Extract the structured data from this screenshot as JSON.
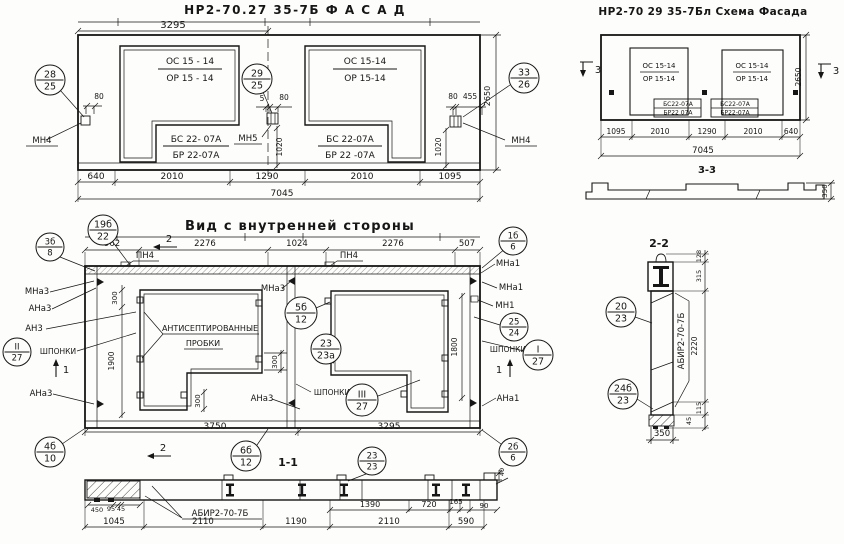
{
  "colors": {
    "ink": "#161616",
    "paper": "#fdfdfb"
  },
  "views": {
    "facade": {
      "title": "НР2-70.27 35-7Б    Ф А С А Д"
    },
    "scheme": {
      "title": "НР2-70 29 35-7Бл  Схема Фасада"
    },
    "inner": {
      "title": "Вид с внутренней стороны"
    },
    "section11": {
      "title": "1-1"
    },
    "section22": {
      "title": "2-2"
    },
    "section33": {
      "title": "3-3"
    }
  },
  "annotations": {
    "facade": [
      {
        "n": "dim-3295",
        "t": "3295",
        "x": 173,
        "y": 28,
        "s": 10
      },
      {
        "n": "window-mark-os",
        "t": "ОС 15 - 14",
        "x": 190,
        "y": 64,
        "s": 9
      },
      {
        "n": "window-mark-or",
        "t": "ОР 15 - 14",
        "x": 190,
        "y": 81,
        "s": 9
      },
      {
        "n": "window-mark-os",
        "t": "ОС 15-14",
        "x": 365,
        "y": 64,
        "s": 9
      },
      {
        "n": "window-mark-or",
        "t": "ОР 15-14",
        "x": 365,
        "y": 81,
        "s": 9
      },
      {
        "n": "sill-mark-bs",
        "t": "БС 22- 07А",
        "x": 196,
        "y": 142,
        "s": 9
      },
      {
        "n": "sill-mark-br",
        "t": "БР 22-07А",
        "x": 196,
        "y": 158,
        "s": 9
      },
      {
        "n": "sill-mark-bs",
        "t": "БС 22-07А",
        "x": 350,
        "y": 142,
        "s": 9
      },
      {
        "n": "sill-mark-br",
        "t": "БР 22 -07А",
        "x": 350,
        "y": 158,
        "s": 9
      },
      {
        "n": "dim-80",
        "t": "80",
        "x": 99,
        "y": 99,
        "s": 7.5
      },
      {
        "n": "anchor-label-mn4",
        "t": "МН4",
        "x": 42,
        "y": 143,
        "s": 8.5
      },
      {
        "n": "dim-5",
        "t": "5",
        "x": 262,
        "y": 101,
        "s": 7.5
      },
      {
        "n": "dim-80",
        "t": "80",
        "x": 284,
        "y": 100,
        "s": 7.5
      },
      {
        "n": "anchor-label-mn5",
        "t": "МН5",
        "x": 248,
        "y": 141,
        "s": 8.5
      },
      {
        "n": "dim-1020",
        "t": "1020",
        "x": 282,
        "y": 147,
        "s": 7.5,
        "r": -90
      },
      {
        "n": "dim-80",
        "t": "80",
        "x": 453,
        "y": 99,
        "s": 7.5
      },
      {
        "n": "dim-455",
        "t": "455",
        "x": 470,
        "y": 99,
        "s": 7.5
      },
      {
        "n": "dim-1020",
        "t": "1020",
        "x": 441,
        "y": 147,
        "s": 7.5,
        "r": -90
      },
      {
        "n": "anchor-label-mn4",
        "t": "МН4",
        "x": 521,
        "y": 143,
        "s": 8.5
      },
      {
        "n": "dim-2650",
        "t": "2650",
        "x": 490,
        "y": 96,
        "s": 8,
        "r": -90
      },
      {
        "n": "dim-640",
        "t": "640",
        "x": 96,
        "y": 179,
        "s": 9
      },
      {
        "n": "dim-2010",
        "t": "2010",
        "x": 172,
        "y": 179,
        "s": 9
      },
      {
        "n": "dim-1290",
        "t": "1290",
        "x": 267,
        "y": 179,
        "s": 9
      },
      {
        "n": "dim-2010",
        "t": "2010",
        "x": 362,
        "y": 179,
        "s": 9
      },
      {
        "n": "dim-1095",
        "t": "1095",
        "x": 450,
        "y": 179,
        "s": 9
      },
      {
        "n": "dim-7045",
        "t": "7045",
        "x": 282,
        "y": 196,
        "s": 9
      }
    ],
    "scheme": [
      {
        "n": "window-mark-os",
        "t": "ОС 15-14",
        "x": 659,
        "y": 68,
        "s": 7
      },
      {
        "n": "window-mark-or",
        "t": "ОР 15-14",
        "x": 659,
        "y": 81,
        "s": 7
      },
      {
        "n": "window-mark-os",
        "t": "ОС 15-14",
        "x": 752,
        "y": 68,
        "s": 7
      },
      {
        "n": "window-mark-or",
        "t": "ОР 15-14",
        "x": 752,
        "y": 81,
        "s": 7
      },
      {
        "n": "sill-mark-bs",
        "t": "БС22-07А",
        "x": 678,
        "y": 106,
        "s": 6
      },
      {
        "n": "sill-mark-br",
        "t": "БР22 07А",
        "x": 678,
        "y": 114.5,
        "s": 6
      },
      {
        "n": "sill-mark-bs",
        "t": "БС22-07А",
        "x": 735,
        "y": 106,
        "s": 6
      },
      {
        "n": "sill-mark-br",
        "t": "БР22-07А",
        "x": 735,
        "y": 114.5,
        "s": 6
      },
      {
        "n": "section-marker-3",
        "t": "3",
        "x": 598,
        "y": 73,
        "s": 10
      },
      {
        "n": "section-marker-3",
        "t": "3",
        "x": 836,
        "y": 74,
        "s": 10
      },
      {
        "n": "dim-2650",
        "t": "2650",
        "x": 801,
        "y": 77,
        "s": 7.5,
        "r": -90
      },
      {
        "n": "dim-1095",
        "t": "1095",
        "x": 616,
        "y": 134,
        "s": 7.5
      },
      {
        "n": "dim-2010",
        "t": "2010",
        "x": 660,
        "y": 134,
        "s": 7.5
      },
      {
        "n": "dim-1290",
        "t": "1290",
        "x": 707,
        "y": 134,
        "s": 7.5
      },
      {
        "n": "dim-2010",
        "t": "2010",
        "x": 753,
        "y": 134,
        "s": 7.5
      },
      {
        "n": "dim-640",
        "t": "640",
        "x": 791,
        "y": 134,
        "s": 7.5
      },
      {
        "n": "dim-7045",
        "t": "7045",
        "x": 703,
        "y": 153,
        "s": 8.5
      },
      {
        "n": "dim-350",
        "t": "350",
        "x": 827,
        "y": 191,
        "s": 7,
        "r": -90
      }
    ],
    "inner": [
      {
        "n": "dim-962",
        "t": "962",
        "x": 112,
        "y": 246,
        "s": 8.5
      },
      {
        "n": "dim-2276",
        "t": "2276",
        "x": 205,
        "y": 246,
        "s": 8.5
      },
      {
        "n": "dim-1024",
        "t": "1024",
        "x": 297,
        "y": 246,
        "s": 8.5
      },
      {
        "n": "dim-2276",
        "t": "2276",
        "x": 393,
        "y": 246,
        "s": 8.5
      },
      {
        "n": "dim-507",
        "t": "507",
        "x": 467,
        "y": 246,
        "s": 8.5
      },
      {
        "n": "plate-label-pn4",
        "t": "ПН4",
        "x": 145,
        "y": 258,
        "s": 8.5
      },
      {
        "n": "plate-label-pn4",
        "t": "ПН4",
        "x": 349,
        "y": 258,
        "s": 8.5
      },
      {
        "n": "section-marker-2",
        "t": "2",
        "x": 169,
        "y": 242,
        "s": 10
      },
      {
        "n": "section-marker-2",
        "t": "2",
        "x": 163,
        "y": 451,
        "s": 10
      },
      {
        "n": "anchor-label-mna3",
        "t": "МНа3",
        "x": 37,
        "y": 294,
        "s": 8.5
      },
      {
        "n": "anchor-label-ana3",
        "t": "АНа3",
        "x": 40,
        "y": 311,
        "s": 8.5
      },
      {
        "n": "anchor-label-an3",
        "t": "АН3",
        "x": 34,
        "y": 331,
        "s": 8.5
      },
      {
        "n": "keys-label",
        "t": "ШПОНКИ",
        "x": 58,
        "y": 354,
        "s": 7.5
      },
      {
        "n": "anchor-label-ana3",
        "t": "АНа3",
        "x": 41,
        "y": 396,
        "s": 8.5
      },
      {
        "n": "section-marker-1",
        "t": "1",
        "x": 66,
        "y": 373,
        "s": 10
      },
      {
        "n": "section-marker-1",
        "t": "1",
        "x": 499,
        "y": 373,
        "s": 10
      },
      {
        "n": "dim-300",
        "t": "300",
        "x": 117,
        "y": 298,
        "s": 7,
        "r": -90
      },
      {
        "n": "dim-1900",
        "t": "1900",
        "x": 114,
        "y": 361,
        "s": 7.5,
        "r": -90
      },
      {
        "n": "note-antiseptic-plugs-line1",
        "t": "АНТИСЕПТИРОВАННЫЕ",
        "x": 210,
        "y": 331,
        "s": 8
      },
      {
        "n": "note-antiseptic-plugs-line2",
        "t": "ПРОБКИ",
        "x": 203,
        "y": 346,
        "s": 8
      },
      {
        "n": "dim-300",
        "t": "300",
        "x": 277,
        "y": 362,
        "s": 7,
        "r": -90
      },
      {
        "n": "dim-300",
        "t": "300",
        "x": 200,
        "y": 401,
        "s": 7,
        "r": -90
      },
      {
        "n": "anchor-label-mna3",
        "t": "МНа3",
        "x": 273,
        "y": 291,
        "s": 8.5
      },
      {
        "n": "keys-label",
        "t": "ШПОНКИ",
        "x": 332,
        "y": 395,
        "s": 7.5
      },
      {
        "n": "anchor-label-ana3",
        "t": "АНа3",
        "x": 262,
        "y": 401,
        "s": 8.5
      },
      {
        "n": "dim-1800",
        "t": "1800",
        "x": 457,
        "y": 347,
        "s": 7.5,
        "r": -90
      },
      {
        "n": "anchor-label-mna1",
        "t": "МНа1",
        "x": 508,
        "y": 266,
        "s": 8.5
      },
      {
        "n": "anchor-label-mna1",
        "t": "МНа1",
        "x": 511,
        "y": 290,
        "s": 8.5
      },
      {
        "n": "anchor-label-mn1",
        "t": "МН1",
        "x": 505,
        "y": 308,
        "s": 8.5
      },
      {
        "n": "keys-label",
        "t": "ШПОНКИ",
        "x": 508,
        "y": 352,
        "s": 7.5
      },
      {
        "n": "anchor-label-ana1",
        "t": "АНа1",
        "x": 508,
        "y": 401,
        "s": 8.5
      },
      {
        "n": "dim-3750",
        "t": "3750",
        "x": 215,
        "y": 429,
        "s": 9
      },
      {
        "n": "dim-3295",
        "t": "3295",
        "x": 389,
        "y": 429,
        "s": 9
      }
    ],
    "section11": [
      {
        "n": "dim-450",
        "t": "450",
        "x": 97,
        "y": 512,
        "s": 6.5
      },
      {
        "n": "dim-95",
        "t": "95",
        "x": 111,
        "y": 511,
        "s": 6.5
      },
      {
        "n": "dim-45",
        "t": "45",
        "x": 121,
        "y": 511,
        "s": 6.5
      },
      {
        "n": "panel-mark-abir",
        "t": "АБИР2-70-7Б",
        "x": 220,
        "y": 516,
        "s": 8.5
      },
      {
        "n": "dim-1390",
        "t": "1390",
        "x": 370,
        "y": 507,
        "s": 8
      },
      {
        "n": "dim-720",
        "t": "720",
        "x": 429,
        "y": 507,
        "s": 8
      },
      {
        "n": "dim-165",
        "t": "165",
        "x": 456,
        "y": 504,
        "s": 7
      },
      {
        "n": "dim-90",
        "t": "90",
        "x": 484,
        "y": 508,
        "s": 7
      },
      {
        "n": "dim-40",
        "t": "40",
        "x": 504,
        "y": 472,
        "s": 6.5,
        "r": -90
      },
      {
        "n": "dim-1045",
        "t": "1045",
        "x": 114,
        "y": 524,
        "s": 8.5
      },
      {
        "n": "dim-2110",
        "t": "2110",
        "x": 203,
        "y": 524,
        "s": 8.5
      },
      {
        "n": "dim-1190",
        "t": "1190",
        "x": 296,
        "y": 524,
        "s": 8.5
      },
      {
        "n": "dim-2110",
        "t": "2110",
        "x": 389,
        "y": 524,
        "s": 8.5
      },
      {
        "n": "dim-590",
        "t": "590",
        "x": 466,
        "y": 524,
        "s": 8.5
      }
    ],
    "section22": [
      {
        "n": "panel-mark-abir",
        "t": "АБИР2-70-7Б",
        "x": 684,
        "y": 341,
        "s": 8.5,
        "r": -90
      },
      {
        "n": "dim-128",
        "t": "128",
        "x": 701,
        "y": 256,
        "s": 6.5,
        "r": -90
      },
      {
        "n": "dim-315",
        "t": "315",
        "x": 701,
        "y": 276,
        "s": 6.5,
        "r": -90
      },
      {
        "n": "dim-2220",
        "t": "2220",
        "x": 697,
        "y": 346,
        "s": 7.5,
        "r": -90
      },
      {
        "n": "dim-115",
        "t": "115",
        "x": 701,
        "y": 408,
        "s": 6.5,
        "r": -90
      },
      {
        "n": "dim-45",
        "t": "45",
        "x": 691,
        "y": 421,
        "s": 6.5,
        "r": -90
      },
      {
        "n": "dim-350",
        "t": "350",
        "x": 662,
        "y": 436,
        "s": 8.5
      }
    ]
  },
  "balloons": [
    {
      "n": "callout-28-25",
      "x": 50,
      "y": 80,
      "r": 15,
      "top": "28",
      "bot": "25"
    },
    {
      "n": "callout-29-25",
      "x": 257,
      "y": 79,
      "r": 15,
      "top": "29",
      "bot": "25"
    },
    {
      "n": "callout-33-26",
      "x": 524,
      "y": 78,
      "r": 15,
      "top": "33",
      "bot": "26"
    },
    {
      "n": "callout-19b-22",
      "x": 103,
      "y": 230,
      "r": 15,
      "top": "19б",
      "bot": "22"
    },
    {
      "n": "callout-3b-8",
      "x": 50,
      "y": 247,
      "r": 14,
      "top": "3б",
      "bot": "8"
    },
    {
      "n": "callout-II-27",
      "x": 17,
      "y": 352,
      "r": 14,
      "top": "II",
      "bot": "27"
    },
    {
      "n": "callout-5b-12",
      "x": 301,
      "y": 313,
      "r": 16,
      "top": "5б",
      "bot": "12"
    },
    {
      "n": "callout-23-23a",
      "x": 326,
      "y": 349,
      "r": 15,
      "top": "23",
      "bot": "23а"
    },
    {
      "n": "callout-III-27",
      "x": 362,
      "y": 400,
      "r": 16,
      "top": "III",
      "bot": "27"
    },
    {
      "n": "callout-I-27",
      "x": 538,
      "y": 355,
      "r": 15,
      "top": "I",
      "bot": "27"
    },
    {
      "n": "callout-1b-6",
      "x": 513,
      "y": 241,
      "r": 14,
      "top": "1б",
      "bot": "6"
    },
    {
      "n": "callout-25-24",
      "x": 514,
      "y": 327,
      "r": 14,
      "top": "25",
      "bot": "24"
    },
    {
      "n": "callout-4b-10",
      "x": 50,
      "y": 452,
      "r": 15,
      "top": "4б",
      "bot": "10"
    },
    {
      "n": "callout-6b-12",
      "x": 246,
      "y": 456,
      "r": 15,
      "top": "6б",
      "bot": "12"
    },
    {
      "n": "callout-23-23",
      "x": 372,
      "y": 461,
      "r": 14,
      "top": "23",
      "bot": "23"
    },
    {
      "n": "callout-2b-6",
      "x": 513,
      "y": 452,
      "r": 14,
      "top": "2б",
      "bot": "6"
    },
    {
      "n": "callout-20-23",
      "x": 621,
      "y": 312,
      "r": 15,
      "top": "20",
      "bot": "23"
    },
    {
      "n": "callout-24b-23",
      "x": 623,
      "y": 394,
      "r": 15,
      "top": "24б",
      "bot": "23"
    }
  ]
}
